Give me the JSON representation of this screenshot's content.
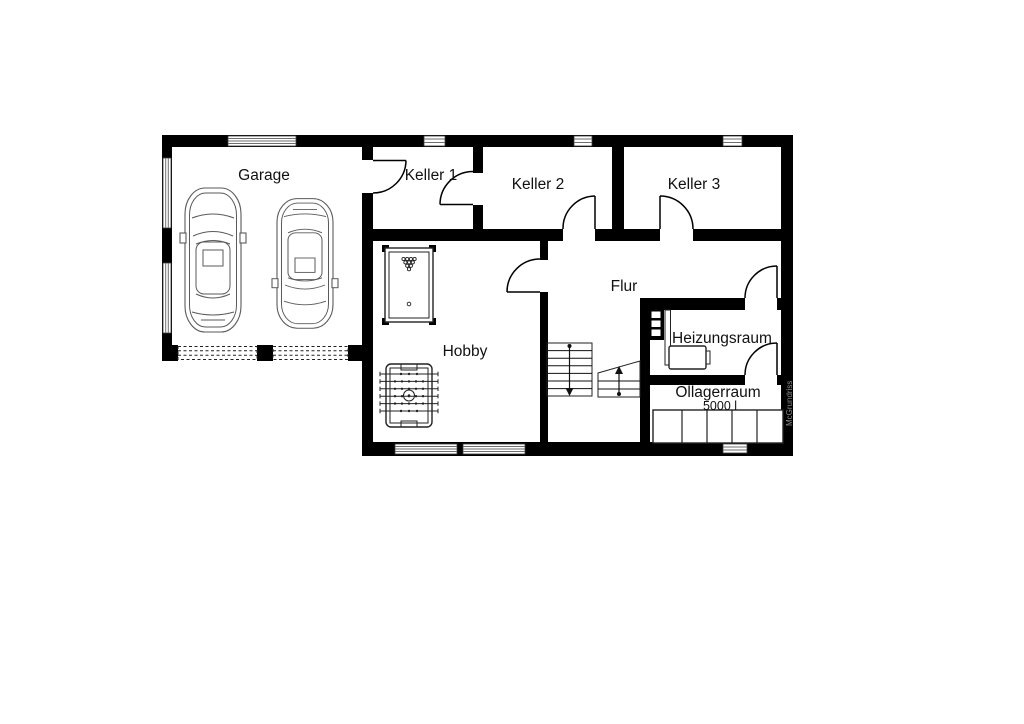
{
  "rooms": [
    {
      "name": "garage",
      "label": "Garage"
    },
    {
      "name": "keller-1",
      "label": "Keller 1"
    },
    {
      "name": "keller-2",
      "label": "Keller 2"
    },
    {
      "name": "keller-3",
      "label": "Keller 3"
    },
    {
      "name": "flur",
      "label": "Flur"
    },
    {
      "name": "hobby",
      "label": "Hobby"
    },
    {
      "name": "heizungsraum",
      "label": "Heizungsraum"
    },
    {
      "name": "oellagerraum",
      "label": "Öllagerraum"
    }
  ],
  "oil_tank_capacity": "5000 l",
  "watermark": "McGrundriss",
  "colors": {
    "wall": "#000000",
    "background": "#ffffff",
    "furniture_line": "#222222",
    "car_line": "#5a5a5a",
    "watermark": "#8c8c8c"
  },
  "icons": {
    "cars": "two-parked-cars-top-view",
    "billiard": "billiard-table",
    "foosball": "foosball-table",
    "stairs": "u-turn-staircase",
    "boiler": "boiler-unit",
    "tanks": "oil-tank-row"
  }
}
